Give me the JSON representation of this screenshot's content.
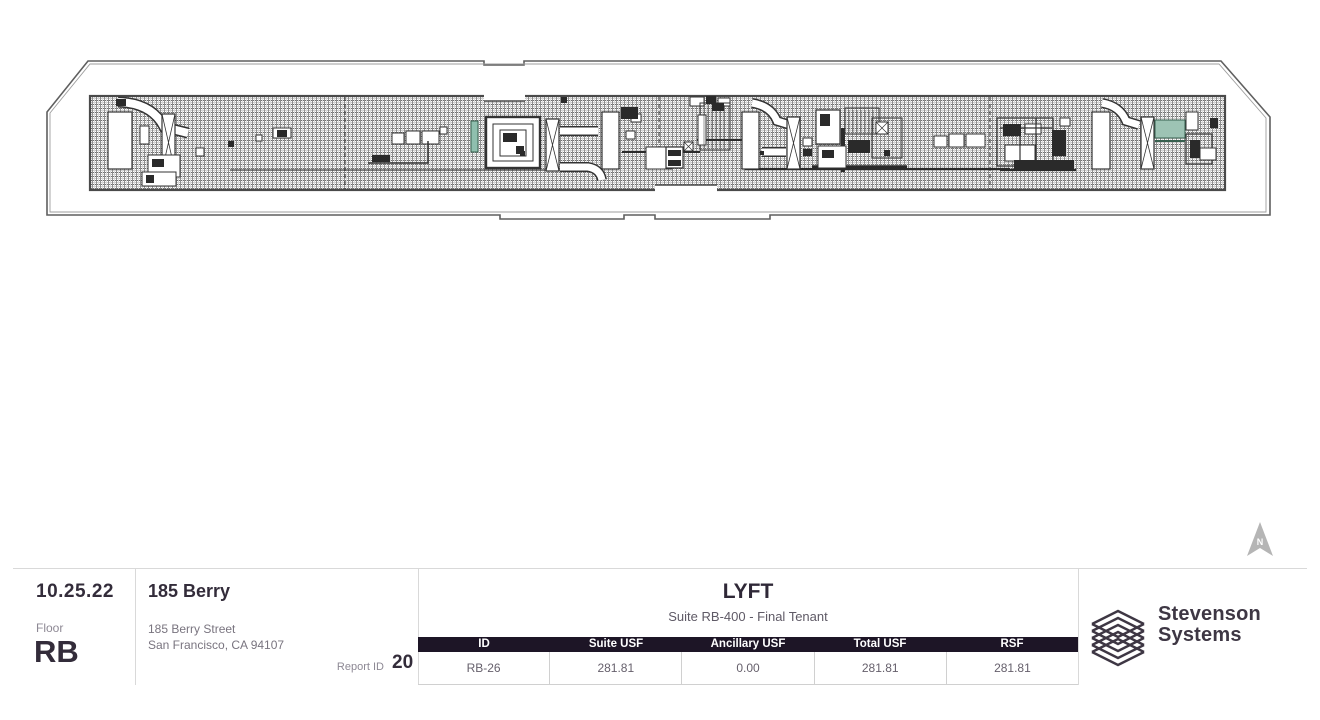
{
  "footer": {
    "date": "10.25.22",
    "floor_label": "Floor",
    "floor_value": "RB",
    "building_name": "185 Berry",
    "address_line1": "185 Berry Street",
    "address_line2": "San Francisco, CA 94107",
    "report_id_label": "Report ID",
    "report_id_value": "20"
  },
  "tenant": {
    "name": "LYFT",
    "suite": "Suite RB-400 - Final Tenant",
    "table": {
      "headers": [
        "ID",
        "Suite USF",
        "Ancillary USF",
        "Total USF",
        "RSF"
      ],
      "row": [
        "RB-26",
        "281.81",
        "0.00",
        "281.81",
        "281.81"
      ]
    }
  },
  "logo": {
    "line1": "Stevenson",
    "line2": "Systems"
  },
  "north_arrow_label": "N",
  "colors": {
    "table_header_bg": "#1d1526",
    "dark_text": "#332c3a",
    "muted_text": "#8d8894",
    "divider": "#d9d9d9",
    "north_arrow": "#b5b5b5",
    "plan_green": "#9dc3b4",
    "plan_line": "#4a4a4a"
  }
}
